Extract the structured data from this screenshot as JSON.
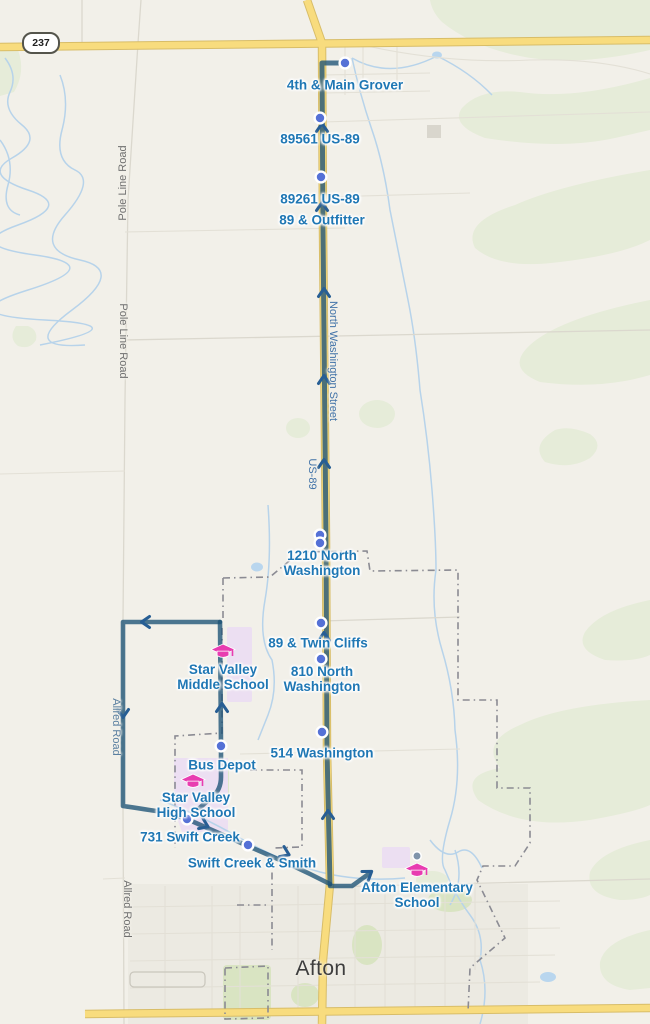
{
  "map": {
    "town": "Afton",
    "highway_shield": "237",
    "colors": {
      "background": "#f2f0e9",
      "route_line": "#4b758f",
      "route_on_highway": "#4c7078",
      "direction_arrow": "#275e94",
      "stop_marker": "#5571d6",
      "stop_label_text": "#1f77b4",
      "school_icon": "#e83cb0",
      "highway_road": "#f8dc7e",
      "boundary_dash": "#8b8b93",
      "water": "#b7d3ea",
      "greenspace": "#e6ecd9",
      "campus_area": "#ecdff2"
    },
    "stops": [
      {
        "label": "4th & Main Grover"
      },
      {
        "label": "89561 US-89"
      },
      {
        "label": "89261 US-89"
      },
      {
        "label": "89 & Outfitter"
      },
      {
        "label": "1210 North\nWashington"
      },
      {
        "label": "89 & Twin Cliffs"
      },
      {
        "label": "810 North\nWashington"
      },
      {
        "label": "514 Washington"
      },
      {
        "label": "Bus Depot"
      },
      {
        "label": "731 Swift Creek"
      },
      {
        "label": "Swift Creek & Smith"
      }
    ],
    "schools": [
      {
        "name": "Star Valley\nMiddle School"
      },
      {
        "name": "Star Valley\nHigh School"
      },
      {
        "name": "Afton Elementary\nSchool"
      }
    ],
    "road_labels": {
      "pole_line_1": "Pole Line Road",
      "pole_line_2": "Pole Line Road",
      "north_washington": "North Washington Street",
      "us_89": "US-89",
      "allred_1": "Allred Road",
      "allred_2": "Allred Road"
    }
  }
}
